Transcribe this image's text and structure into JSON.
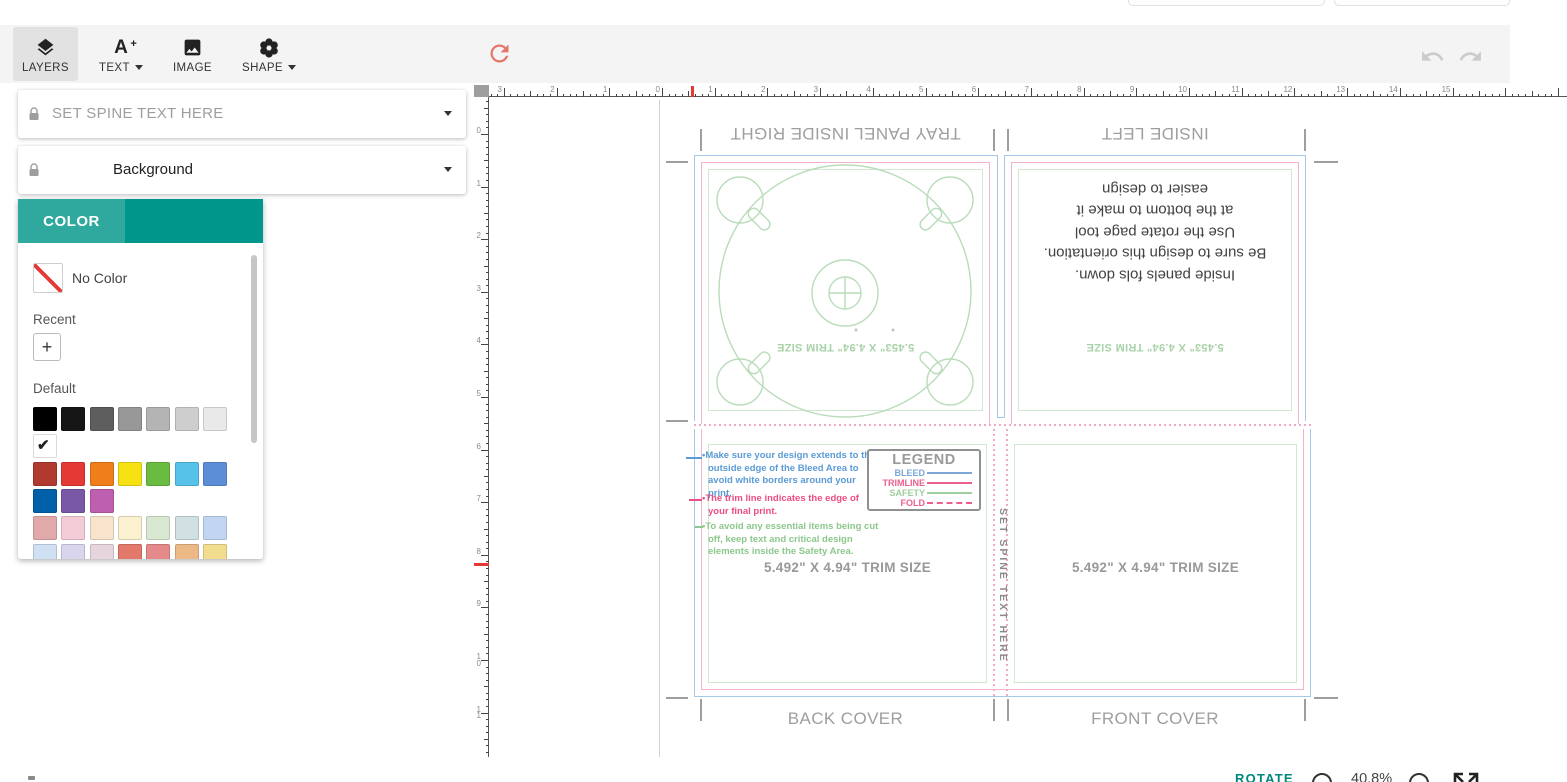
{
  "toolbar": {
    "layers": "LAYERS",
    "text": "TEXT",
    "image": "IMAGE",
    "shape": "SHAPE",
    "text_icon_letter": "A",
    "text_icon_plus": "+"
  },
  "layers_panel": {
    "layers": [
      {
        "name": "SET SPINE TEXT HERE"
      },
      {
        "name": "Background"
      }
    ]
  },
  "color_panel": {
    "tab": "COLOR",
    "no_color": "No Color",
    "recent": "Recent",
    "add_button": "+",
    "default_label": "Default",
    "selected_check": "✔",
    "default_rows": [
      [
        "#000000",
        "#161616",
        "#5e5e5e",
        "#989898",
        "#b4b4b4",
        "#cecece",
        "#e9e9e9"
      ],
      [
        "#ffffff"
      ],
      [
        "#b13a30",
        "#e53935",
        "#ef7e1b",
        "#f6e214",
        "#6abc41",
        "#56c1e9",
        "#5b8ed6"
      ],
      [
        "#0061a8",
        "#7a58a8",
        "#bf5fb0"
      ],
      [
        "#e2a9ab",
        "#f3ccd8",
        "#f8e4cd",
        "#fbf0cf",
        "#d9e8d1",
        "#d1e0e3",
        "#c2d6f1"
      ],
      [
        "#cfe0f2",
        "#d9d5ed",
        "#e7d5de",
        "#e2796a",
        "#e58a8a",
        "#ecb986",
        "#f2dc8e"
      ]
    ],
    "selected_color": "#ffffff"
  },
  "rulers": {
    "unit": "inches",
    "horizontal_labels": [
      "3",
      "2",
      "1",
      "0",
      "1",
      "2",
      "3",
      "4",
      "5",
      "6",
      "7",
      "8",
      "9",
      "10",
      "11",
      "12",
      "13",
      "14",
      "15"
    ],
    "vertical_labels": [
      "0",
      "1",
      "2",
      "3",
      "4",
      "5",
      "6",
      "7",
      "8",
      "9",
      "10",
      "11"
    ]
  },
  "canvas": {
    "panels": {
      "tray": {
        "title": "TRAY PANEL INSIDE RIGHT",
        "trim_label": "5.453\" X 4.94\" TRIM SIZE"
      },
      "inside_left": {
        "title": "INSIDE LEFT",
        "instructions": "Inside panels fols down.\nBe sure to design this orientation.\nUse the rotate page tool\nat the bottom to make it\neasier to design",
        "trim_label": "5.453\" X 4.94\" TRIM SIZE"
      },
      "back_cover": {
        "title": "BACK COVER",
        "trim_label": "5.492\" X 4.94\" TRIM SIZE"
      },
      "front_cover": {
        "title": "FRONT COVER",
        "trim_label": "5.492\" X 4.94\" TRIM SIZE"
      },
      "spine": {
        "text": "SET SPINE TEXT HERE"
      }
    },
    "note_bullet": "•",
    "notes": [
      {
        "text": "Make sure your design extends to the outside edge of the Bleed Area to avoid white borders around your print.",
        "color": "#5b9bd5"
      },
      {
        "text": "The trim line indicates the edge of your final print.",
        "color": "#ec4d82"
      },
      {
        "text": "To avoid any essential items being cut off, keep text and critical design elements inside the Safety Area.",
        "color": "#8cc88c"
      }
    ],
    "legend": {
      "title": "LEGEND",
      "entries": [
        {
          "label": "BLEED",
          "color": "#7da7d9",
          "dashed": false
        },
        {
          "label": "TRIMLINE",
          "color": "#ec5f8f",
          "dashed": false
        },
        {
          "label": "SAFETY",
          "color": "#9fce9f",
          "dashed": false
        },
        {
          "label": "FOLD",
          "color": "#ec5f8f",
          "dashed": true
        }
      ]
    },
    "guide_colors": {
      "bleed": "#a6c8e8",
      "trim": "#f3b3ca",
      "safety": "#cfe8cf",
      "fold": "#f2a9c4",
      "tray_art": "#b9dcba"
    }
  },
  "bottom_bar": {
    "rotate": "ROTATE",
    "zoom": "40.8%"
  }
}
